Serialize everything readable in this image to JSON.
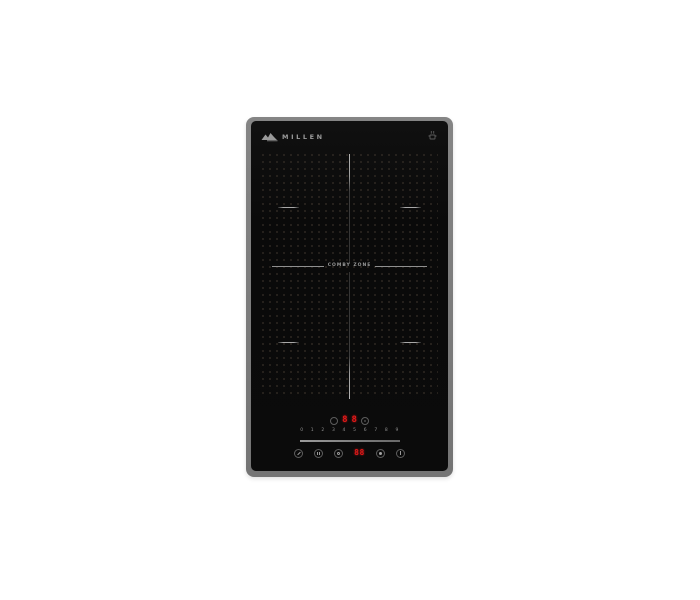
{
  "product": {
    "brand": "MILLEN",
    "zone_label": "COMBY ZONE",
    "type": "domino induction hob"
  },
  "controls": {
    "zone_left_level": "8",
    "zone_right_level": "8",
    "slider_scale": "0 1 2 3 4 5 6 7 8 9",
    "timer_display": "88"
  },
  "icons": {
    "brand_logo": "mountain-swoosh",
    "top_indicator": "pan-symbol",
    "zone_select_left": "circle-outline",
    "zone_select_right": "circle-with-pan-mark",
    "lock": "key-shape",
    "pause": "pause-bars",
    "timer": "clock-shape",
    "boost": "filled-dot",
    "power": "power-line"
  },
  "colors": {
    "frame_gray": "#7b7b7b",
    "glass_black": "#0b0b0b",
    "display_red": "#e01818",
    "zone_marks": "#9a9a9a",
    "dot_grid": "#3b332b",
    "background": "#ffffff"
  }
}
